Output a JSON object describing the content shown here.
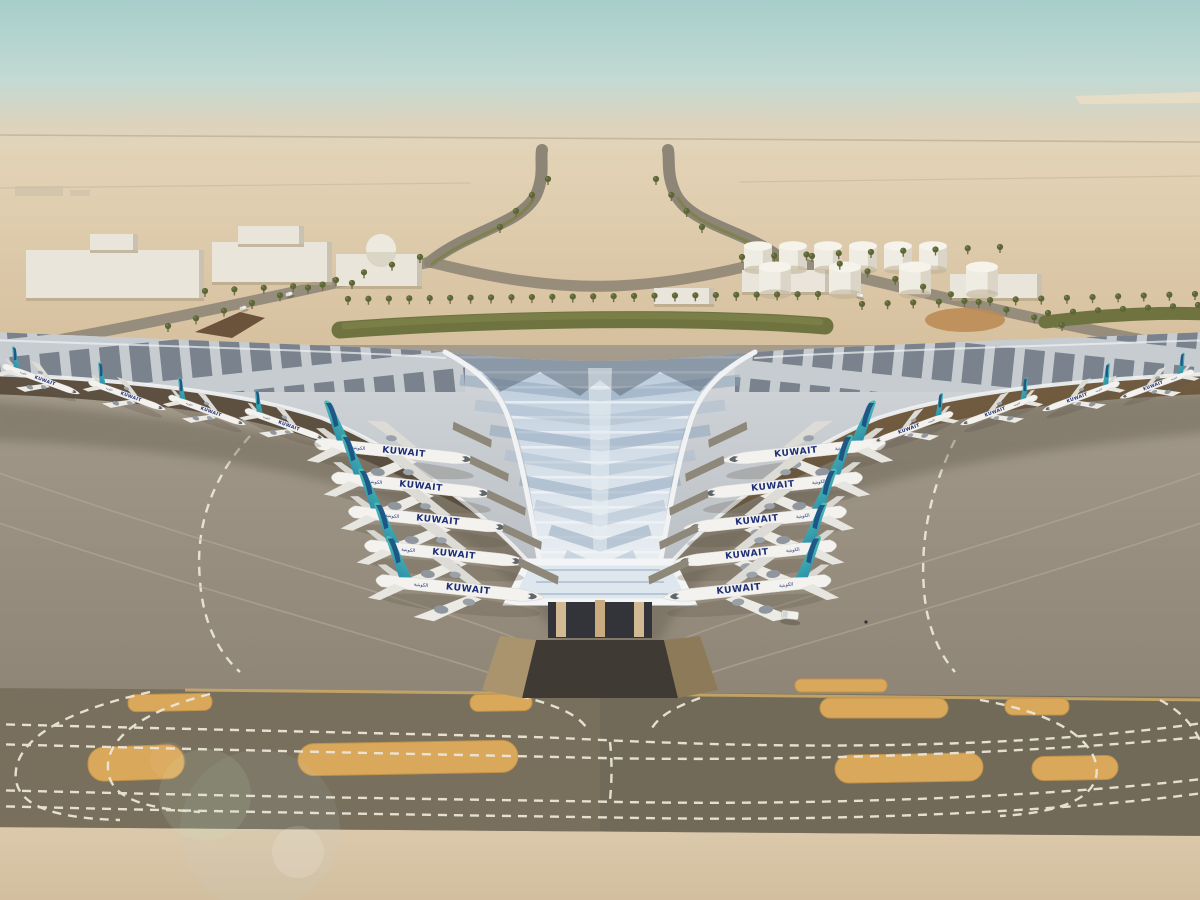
{
  "airline": {
    "label": "KUWAIT",
    "label_ar": "الكويتية"
  },
  "colors": {
    "sky_top": "#a7cecb",
    "sky_mid": "#c3dad3",
    "horizon_haze": "#ddd3bd",
    "desert_far": "#e3d3b6",
    "desert_near": "#d8c3a1",
    "road": "#968d7c",
    "underpass": "#6b523a",
    "building_white": "#e9e5da",
    "tank_white": "#efece3",
    "hedge_green": "#6f7340",
    "palm_green": "#5c6637",
    "roof_silver": "#c9cdd2",
    "roof_stripe_dark": "#5b6673",
    "funnel_light": "#dfe7ee",
    "funnel_blue": "#8aa1ba",
    "funnel_dark": "#5a6673",
    "fascia_white": "#f0f2f3",
    "canopy_dark": "#574a3a",
    "canopy_warm": "#6d5639",
    "column_tan": "#d3b993",
    "glass_dark": "#32343a",
    "apron": "#9c9284",
    "apron_shadow": "#6e6558",
    "taxiway_dark": "#78705d",
    "island_orange": "#d9a85b",
    "curb_orange": "#c9a768",
    "bottom_sand": "#d9c6a7",
    "marking_white": "#ece6d8",
    "fuselage_white": "#f3f2ee",
    "tail_teal": "#57c0b2",
    "tail_blue": "#14427e",
    "livery_navy": "#1e2f78"
  },
  "aircraft": [
    {
      "x": 398,
      "y": 452,
      "s": 1.0,
      "flip": false,
      "rot": 6,
      "size": "large"
    },
    {
      "x": 415,
      "y": 486,
      "s": 1.0,
      "flip": false,
      "rot": 6,
      "size": "large"
    },
    {
      "x": 432,
      "y": 520,
      "s": 1.0,
      "flip": false,
      "rot": 6,
      "size": "large"
    },
    {
      "x": 448,
      "y": 554,
      "s": 1.0,
      "flip": false,
      "rot": 6,
      "size": "large"
    },
    {
      "x": 462,
      "y": 589,
      "s": 1.03,
      "flip": false,
      "rot": 6,
      "size": "large"
    },
    {
      "x": 802,
      "y": 452,
      "s": 1.0,
      "flip": true,
      "rot": -6,
      "size": "large"
    },
    {
      "x": 779,
      "y": 486,
      "s": 1.0,
      "flip": true,
      "rot": -6,
      "size": "large"
    },
    {
      "x": 763,
      "y": 520,
      "s": 1.0,
      "flip": true,
      "rot": -6,
      "size": "large"
    },
    {
      "x": 753,
      "y": 554,
      "s": 1.0,
      "flip": true,
      "rot": -6,
      "size": "large"
    },
    {
      "x": 745,
      "y": 589,
      "s": 1.03,
      "flip": true,
      "rot": -6,
      "size": "large"
    },
    {
      "x": 42,
      "y": 380,
      "s": 0.5,
      "flip": false,
      "rot": 20,
      "size": "small"
    },
    {
      "x": 128,
      "y": 396,
      "s": 0.5,
      "flip": false,
      "rot": 20,
      "size": "small"
    },
    {
      "x": 208,
      "y": 411,
      "s": 0.5,
      "flip": false,
      "rot": 20,
      "size": "small"
    },
    {
      "x": 286,
      "y": 425,
      "s": 0.52,
      "flip": false,
      "rot": 20,
      "size": "small"
    },
    {
      "x": 912,
      "y": 428,
      "s": 0.52,
      "flip": true,
      "rot": -20,
      "size": "small"
    },
    {
      "x": 998,
      "y": 411,
      "s": 0.5,
      "flip": true,
      "rot": -20,
      "size": "small"
    },
    {
      "x": 1080,
      "y": 397,
      "s": 0.5,
      "flip": true,
      "rot": -20,
      "size": "small"
    },
    {
      "x": 1156,
      "y": 385,
      "s": 0.48,
      "flip": true,
      "rot": -20,
      "size": "small"
    }
  ],
  "palm_rows": [
    {
      "x1": 348,
      "y1": 304,
      "x2": 818,
      "y2": 299,
      "n": 24
    },
    {
      "x1": 862,
      "y1": 309,
      "x2": 1195,
      "y2": 299,
      "n": 14
    },
    {
      "x1": 168,
      "y1": 331,
      "x2": 420,
      "y2": 262,
      "n": 10
    },
    {
      "x1": 1062,
      "y1": 330,
      "x2": 812,
      "y2": 261,
      "n": 10
    },
    {
      "x1": 500,
      "y1": 232,
      "x2": 548,
      "y2": 184,
      "n": 4
    },
    {
      "x1": 702,
      "y1": 232,
      "x2": 656,
      "y2": 184,
      "n": 4
    },
    {
      "x1": 742,
      "y1": 262,
      "x2": 1000,
      "y2": 252,
      "n": 9
    },
    {
      "x1": 205,
      "y1": 296,
      "x2": 352,
      "y2": 288,
      "n": 6
    },
    {
      "x1": 1048,
      "y1": 318,
      "x2": 1198,
      "y2": 310,
      "n": 7
    }
  ],
  "tanks": [
    {
      "x": 758,
      "y": 246,
      "r": 14
    },
    {
      "x": 793,
      "y": 246,
      "r": 14
    },
    {
      "x": 828,
      "y": 246,
      "r": 14
    },
    {
      "x": 863,
      "y": 246,
      "r": 14
    },
    {
      "x": 898,
      "y": 246,
      "r": 14
    },
    {
      "x": 933,
      "y": 246,
      "r": 14
    },
    {
      "x": 775,
      "y": 267,
      "r": 16
    },
    {
      "x": 845,
      "y": 267,
      "r": 16
    },
    {
      "x": 915,
      "y": 267,
      "r": 16
    },
    {
      "x": 982,
      "y": 267,
      "r": 16
    }
  ],
  "buildings": [
    {
      "x": 26,
      "y": 250,
      "w": 178,
      "h": 48
    },
    {
      "x": 90,
      "y": 234,
      "w": 48,
      "h": 16
    },
    {
      "x": 212,
      "y": 242,
      "w": 120,
      "h": 40
    },
    {
      "x": 238,
      "y": 226,
      "w": 66,
      "h": 18
    },
    {
      "x": 336,
      "y": 254,
      "w": 86,
      "h": 32
    },
    {
      "x": 742,
      "y": 270,
      "w": 88,
      "h": 22
    },
    {
      "x": 950,
      "y": 274,
      "w": 92,
      "h": 24
    },
    {
      "x": 654,
      "y": 288,
      "w": 60,
      "h": 16
    }
  ],
  "islands": [
    {
      "x": 128,
      "y": 694,
      "w": 84,
      "h": 17,
      "r": 8,
      "rot": -1
    },
    {
      "x": 470,
      "y": 694,
      "w": 62,
      "h": 17,
      "r": 8,
      "rot": -1
    },
    {
      "x": 795,
      "y": 679,
      "w": 92,
      "h": 13,
      "r": 6,
      "rot": 0
    },
    {
      "x": 820,
      "y": 698,
      "w": 128,
      "h": 20,
      "r": 10,
      "rot": 0
    },
    {
      "x": 1005,
      "y": 698,
      "w": 64,
      "h": 17,
      "r": 8,
      "rot": 0
    },
    {
      "x": 88,
      "y": 746,
      "w": 96,
      "h": 34,
      "r": 16,
      "rot": -2
    },
    {
      "x": 298,
      "y": 742,
      "w": 220,
      "h": 32,
      "r": 16,
      "rot": -1
    },
    {
      "x": 835,
      "y": 754,
      "w": 148,
      "h": 28,
      "r": 14,
      "rot": -1
    },
    {
      "x": 1032,
      "y": 756,
      "w": 86,
      "h": 24,
      "r": 12,
      "rot": -1
    }
  ],
  "vehicles": [
    {
      "x": 790,
      "y": 615,
      "w": 17,
      "h": 8,
      "rot": 6
    },
    {
      "x": 243,
      "y": 308,
      "w": 7,
      "h": 3.5,
      "rot": -18
    },
    {
      "x": 289,
      "y": 294,
      "w": 7,
      "h": 3.5,
      "rot": -18
    },
    {
      "x": 860,
      "y": 295,
      "w": 7,
      "h": 3.5,
      "rot": 14
    }
  ],
  "person": {
    "x": 866,
    "y": 622
  }
}
